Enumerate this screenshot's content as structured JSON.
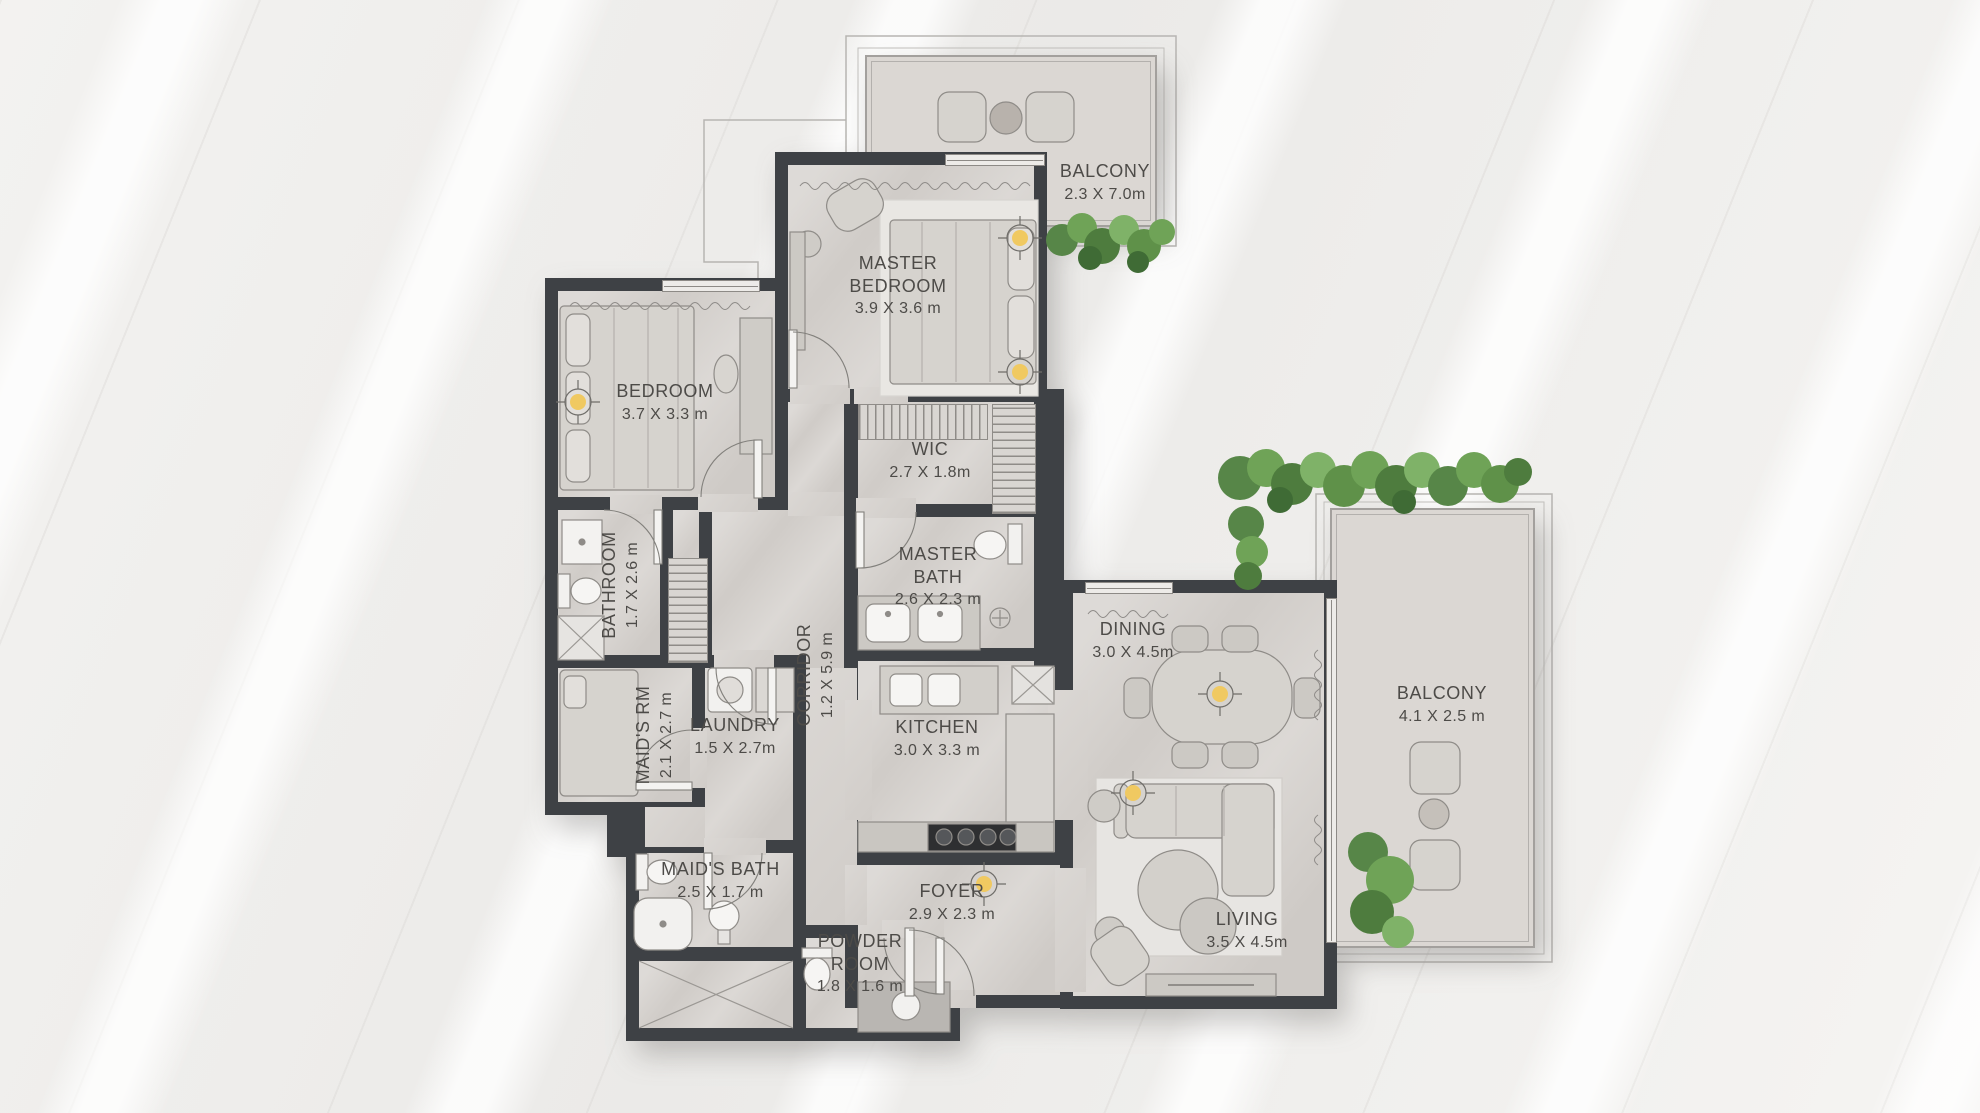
{
  "rooms": [
    {
      "id": "balcony-top",
      "name": "BALCONY",
      "dims": "2.3 X 7.0m"
    },
    {
      "id": "master-bedroom",
      "name": "MASTER BEDROOM",
      "dims": "3.9 X 3.6 m"
    },
    {
      "id": "bedroom",
      "name": "BEDROOM",
      "dims": "3.7 X 3.3 m"
    },
    {
      "id": "wic",
      "name": "WIC",
      "dims": "2.7 X 1.8m"
    },
    {
      "id": "bathroom",
      "name": "BATHROOM",
      "dims": "1.7 X 2.6 m"
    },
    {
      "id": "master-bath",
      "name": "MASTER BATH",
      "dims": "2.6 X 2.3 m"
    },
    {
      "id": "corridor",
      "name": "CORRIDOR",
      "dims": "1.2 X 5.9 m"
    },
    {
      "id": "maids-rm",
      "name": "MAID'S RM",
      "dims": "2.1 X 2.7 m"
    },
    {
      "id": "laundry",
      "name": "LAUNDRY",
      "dims": "1.5 X 2.7m"
    },
    {
      "id": "maids-bath",
      "name": "MAID'S BATH",
      "dims": "2.5 X 1.7 m"
    },
    {
      "id": "powder-room",
      "name": "POWDER ROOM",
      "dims": "1.8 X 1.6 m"
    },
    {
      "id": "foyer",
      "name": "FOYER",
      "dims": "2.9 X 2.3 m"
    },
    {
      "id": "kitchen",
      "name": "KITCHEN",
      "dims": "3.0 X 3.3 m"
    },
    {
      "id": "dining",
      "name": "DINING",
      "dims": "3.0 X 4.5m"
    },
    {
      "id": "living",
      "name": "LIVING",
      "dims": "3.5 X 4.5m"
    },
    {
      "id": "balcony-right",
      "name": "BALCONY",
      "dims": "4.1 X 2.5 m"
    }
  ],
  "colors": {
    "wall": "#3e4145",
    "floor": "#d5d1cd",
    "balcony_floor": "#dbd7d3",
    "plant_green": "#6fa357",
    "light_symbol": "#f0c961",
    "label_text": "#4d4b48"
  }
}
